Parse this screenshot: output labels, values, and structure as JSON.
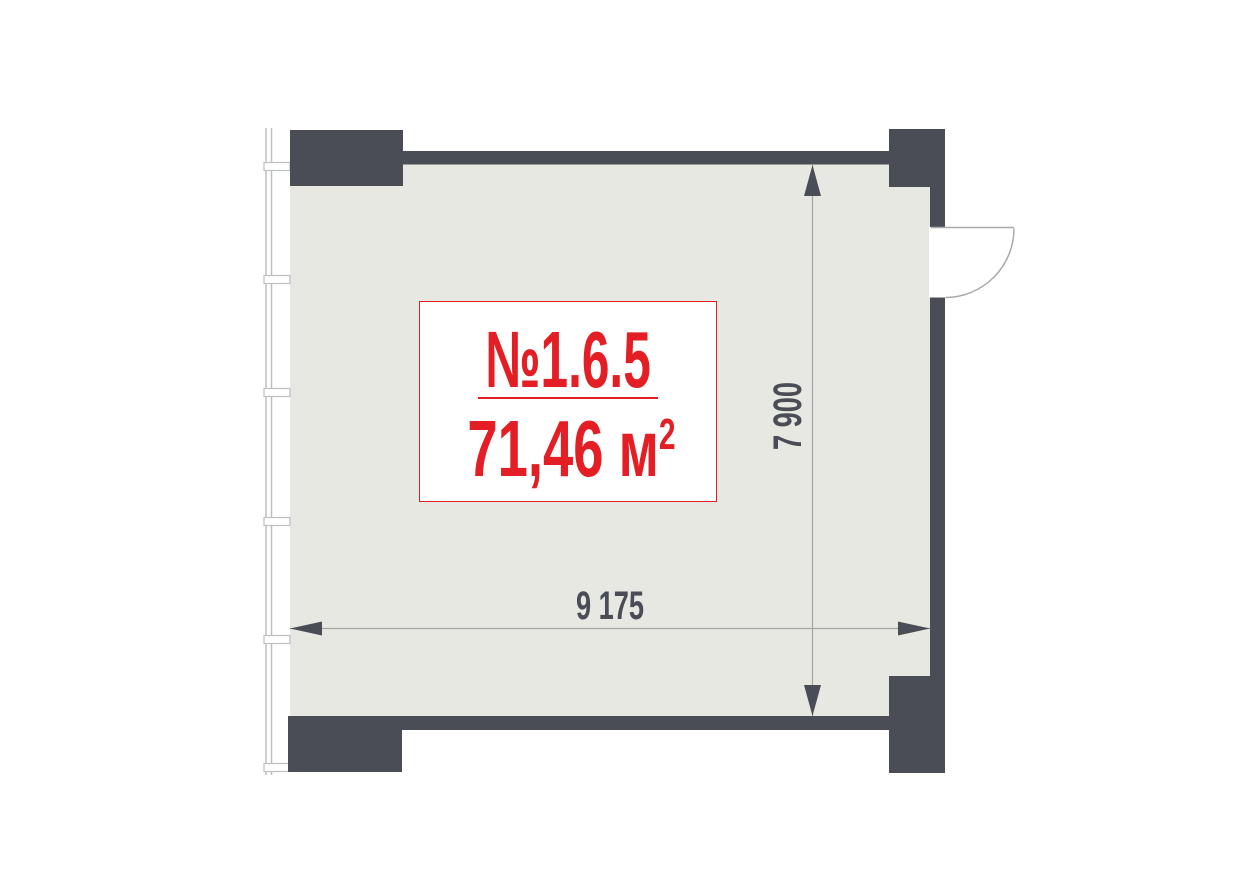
{
  "unit_card": {
    "number": "№1.6.5",
    "area_value": "71,46 м",
    "area_superscript": "2"
  },
  "dimensions": {
    "width_label": "9 175",
    "height_label": "7 900"
  },
  "colors": {
    "wall": "#4a4d55",
    "floor": "#e8e8e3",
    "accent_red": "#e31e24",
    "dimension_line": "#a3a5a2",
    "window_line": "#bcc0c2",
    "door_arc": "#a6aaac"
  }
}
